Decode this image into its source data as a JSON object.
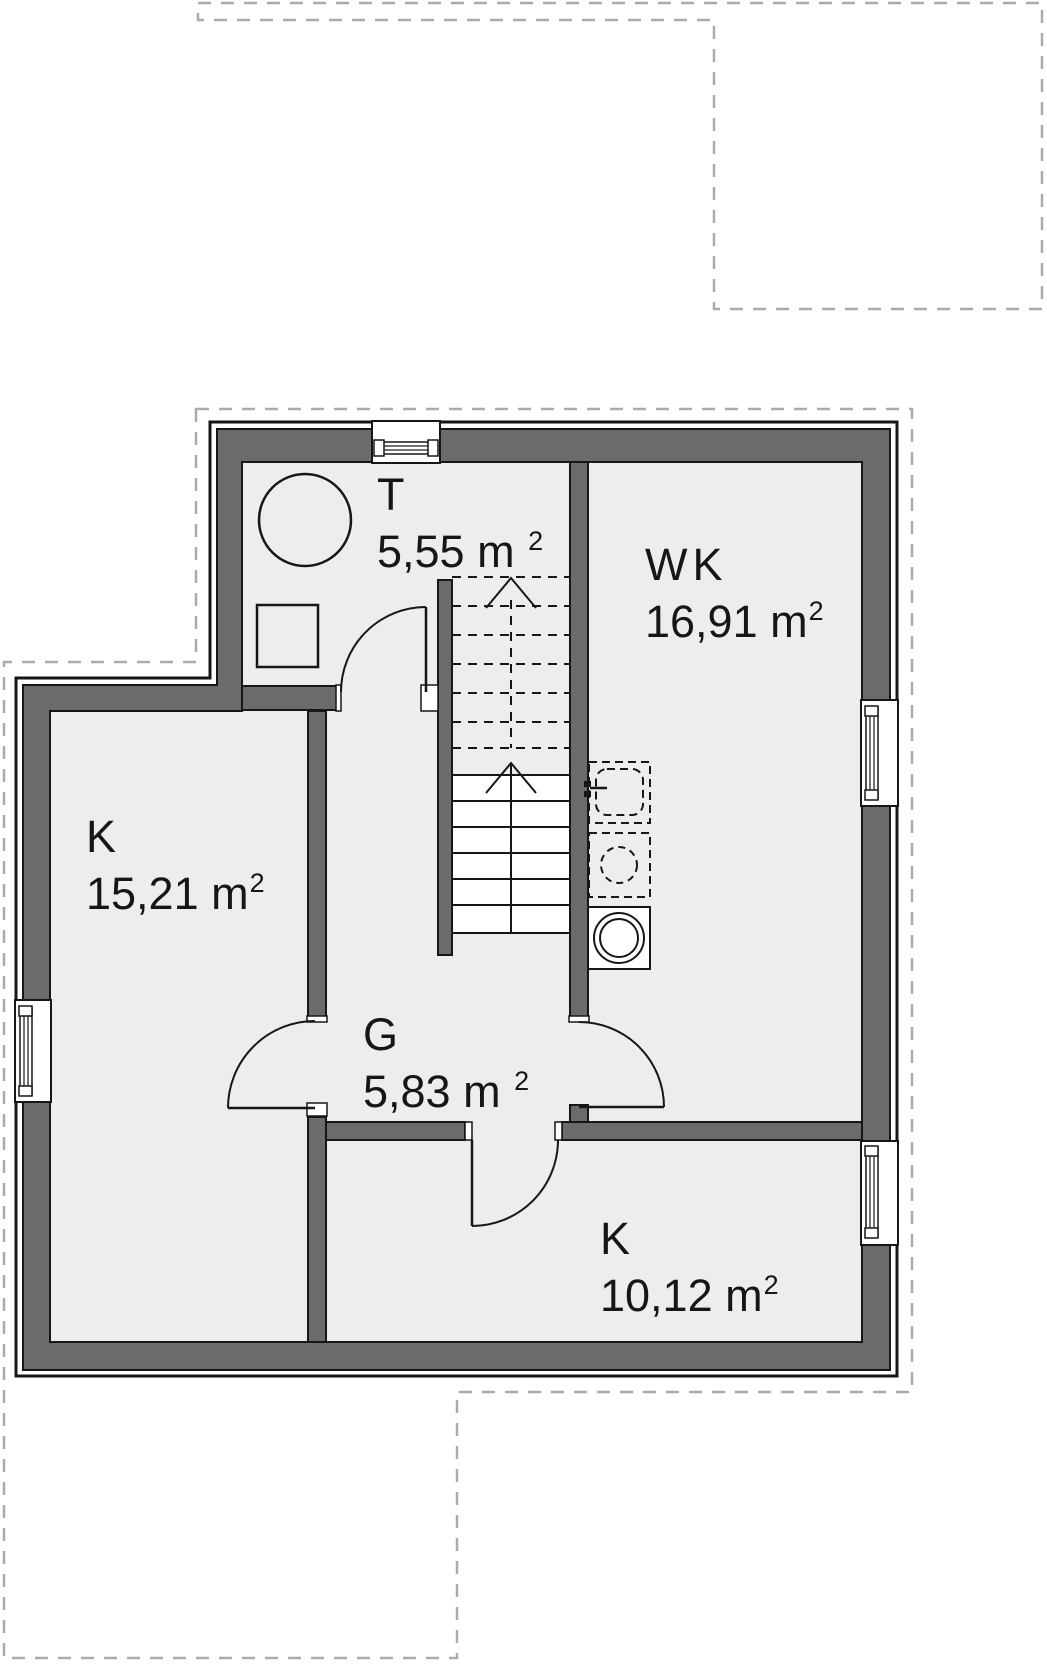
{
  "document": {
    "type": "architectural-floor-plan",
    "floor": "upper floor plan with staircase",
    "units": "m2"
  },
  "rooms": [
    {
      "id": "toilet",
      "label": "T",
      "area": "5,55 m ",
      "sup": "2"
    },
    {
      "id": "living-room",
      "label": "WK",
      "area": "16,91 m",
      "sup": "2"
    },
    {
      "id": "room-left",
      "label": "K",
      "area": "15,21 m",
      "sup": "2"
    },
    {
      "id": "hallway",
      "label": "G",
      "area": "5,83 m ",
      "sup": "2"
    },
    {
      "id": "room-bottom",
      "label": "K",
      "area": "10,12 m",
      "sup": "2"
    }
  ],
  "stairs": {
    "direction": "up",
    "dashed_treads": 7,
    "solid_treads": 6
  },
  "fixtures": [
    "round-table-or-shower",
    "washbasin-square",
    "kitchen-sink-dashed",
    "cooktop-dashed-circle",
    "washing-machine",
    "window-top",
    "window-left",
    "window-right-living",
    "window-right-bottom"
  ],
  "doors": [
    "toilet-door",
    "room-left-door",
    "living-room-door",
    "room-bottom-door"
  ],
  "colors": {
    "wall_fill": "#6b6b6b",
    "outline": "#161616",
    "floor": "#ededed",
    "lower_floor_dash": "#ababab",
    "background": "#ffffff"
  }
}
